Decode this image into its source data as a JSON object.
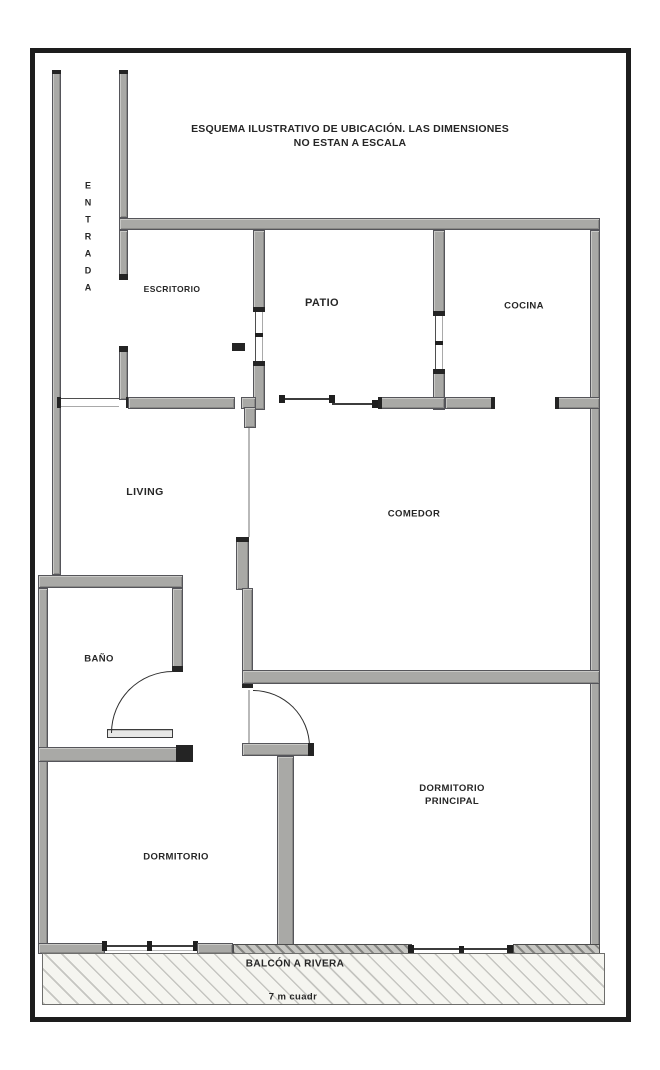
{
  "title": {
    "line1": "ESQUEMA ILUSTRATIVO DE UBICACIÓN. LAS DIMENSIONES",
    "line2": "NO ESTAN A ESCALA"
  },
  "rooms": {
    "entrada": {
      "label": "ENTRADA"
    },
    "escritorio": {
      "label": "ESCRITORIO"
    },
    "patio": {
      "label": "PATIO"
    },
    "cocina": {
      "label": "COCINA"
    },
    "living": {
      "label": "LIVING"
    },
    "comedor": {
      "label": "COMEDOR"
    },
    "bano": {
      "label": "BAÑO"
    },
    "dormitorio": {
      "label": "DORMITORIO"
    },
    "dormitorio_principal": {
      "label": "DORMITORIO PRINCIPAL"
    }
  },
  "balcony": {
    "label": "BALCÓN A RIVERA",
    "area": "7 m cuadr"
  },
  "colors": {
    "wall": "#a9a9a6",
    "wall_edge": "#55555a",
    "frame": "#1d1d1d",
    "hatch_background": "#f5f5f0",
    "text": "#262626"
  }
}
